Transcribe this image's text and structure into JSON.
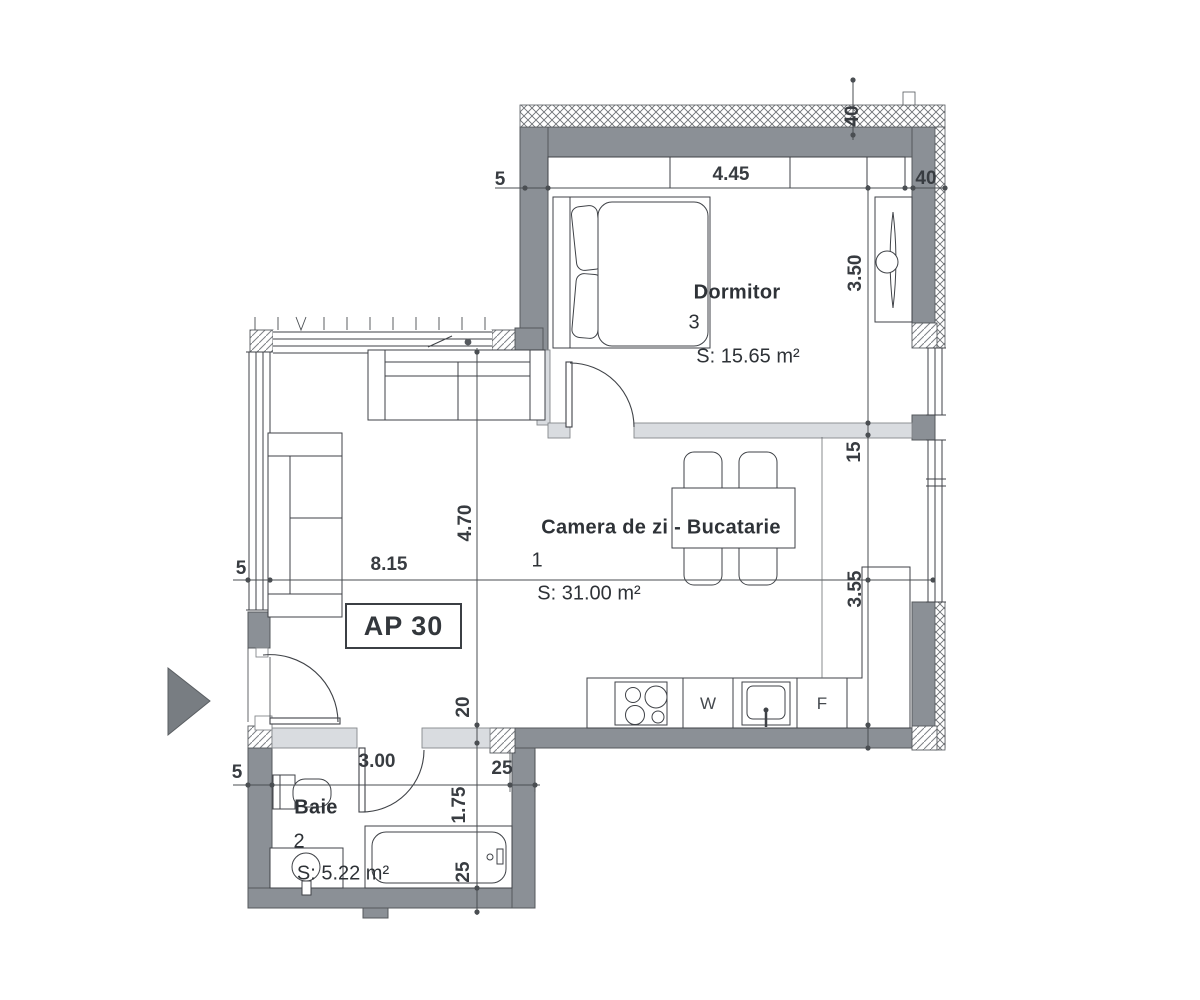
{
  "apartment": {
    "label": "AP 30"
  },
  "rooms": {
    "bedroom": {
      "name": "Dormitor",
      "number": "3",
      "area": "S: 15.65 m²"
    },
    "living": {
      "name": "Camera de zi - Bucatarie",
      "number": "1",
      "area": "S: 31.00 m²"
    },
    "bath": {
      "name": "Baie",
      "number": "2",
      "area": "S: 5.22 m²"
    }
  },
  "appliances": {
    "washer": "W",
    "fridge": "F"
  },
  "dims": {
    "d445": "4.45",
    "d40a": "40",
    "d40b": "40",
    "d350": "3.50",
    "d15": "15",
    "d355": "3.55",
    "d470": "4.70",
    "d815": "8.15",
    "d5a": "5",
    "d5b": "5",
    "d5c": "5",
    "d20": "20",
    "d300": "3.00",
    "d25a": "25",
    "d175": "1.75",
    "d25b": "25"
  },
  "colors": {
    "wall": "#8b9096",
    "partition": "#d9dce0",
    "line": "#3f4247",
    "arrow": "#787d82",
    "hatch": "#6d7175"
  }
}
